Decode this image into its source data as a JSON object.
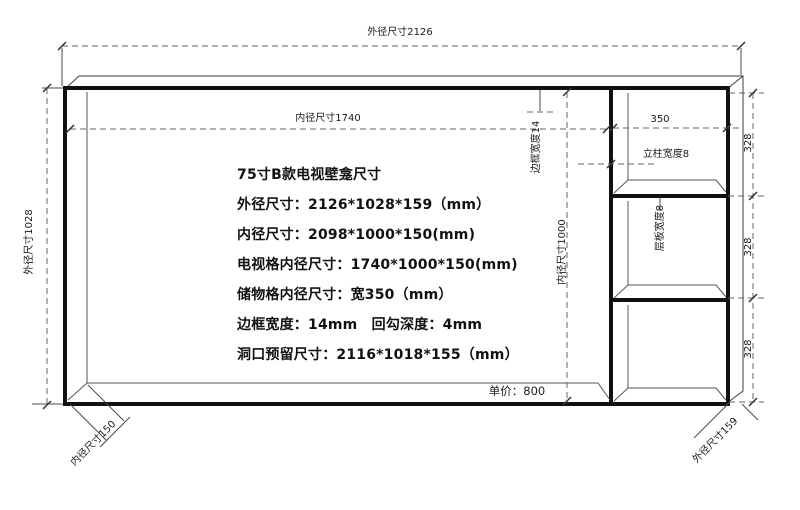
{
  "drawing": {
    "labels": {
      "outer_width": "外径尺寸2126",
      "inner_width": "内径尺寸1740",
      "outer_height": "外径尺寸1028",
      "frame_width": "边框宽度14",
      "inner_height": "内径尺寸1000",
      "storage_width": "350",
      "column_width": "立柱宽度8",
      "shelf_width": "层板宽度8",
      "cell_height_1": "328",
      "cell_height_2": "328",
      "cell_height_3": "328",
      "inner_depth": "内径尺寸150",
      "outer_depth": "外径尺寸159"
    },
    "price": "单价：800",
    "specs": [
      "75寸B款电视壁龛尺寸",
      "外径尺寸：2126*1028*159（mm）",
      "内径尺寸：2098*1000*150(mm)",
      "电视格内径尺寸：1740*1000*150(mm)",
      "储物格内径尺寸：宽350（mm）",
      "边框宽度：14mm　回勾深度：4mm",
      "洞口预留尺寸：2116*1018*155（mm）"
    ],
    "line_colors": {
      "thick": "#111111",
      "thin": "#4a4a4a",
      "dashed": "#666666"
    }
  }
}
